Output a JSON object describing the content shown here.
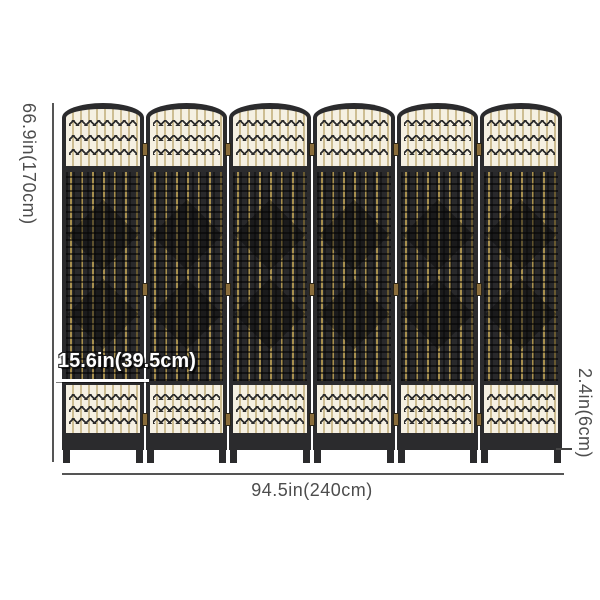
{
  "product": {
    "name": "6-panel wicker folding room divider",
    "panel_count": 6
  },
  "dimensions": {
    "height_label": "66.9in(170cm)",
    "total_width_label": "94.5in(240cm)",
    "panel_width_label": "15.6in(39.5cm)",
    "leg_height_label": "2.4in(6cm)"
  },
  "colors": {
    "frame": "#2b2b2d",
    "weave": "#29292b",
    "gold": "#a8904f",
    "cream": "#f5f0e2",
    "stripe": "#cdbd92",
    "knot": "#2c2c2c",
    "hinge": "#8a6d3b",
    "dimension_text": "#4d4d4d"
  }
}
